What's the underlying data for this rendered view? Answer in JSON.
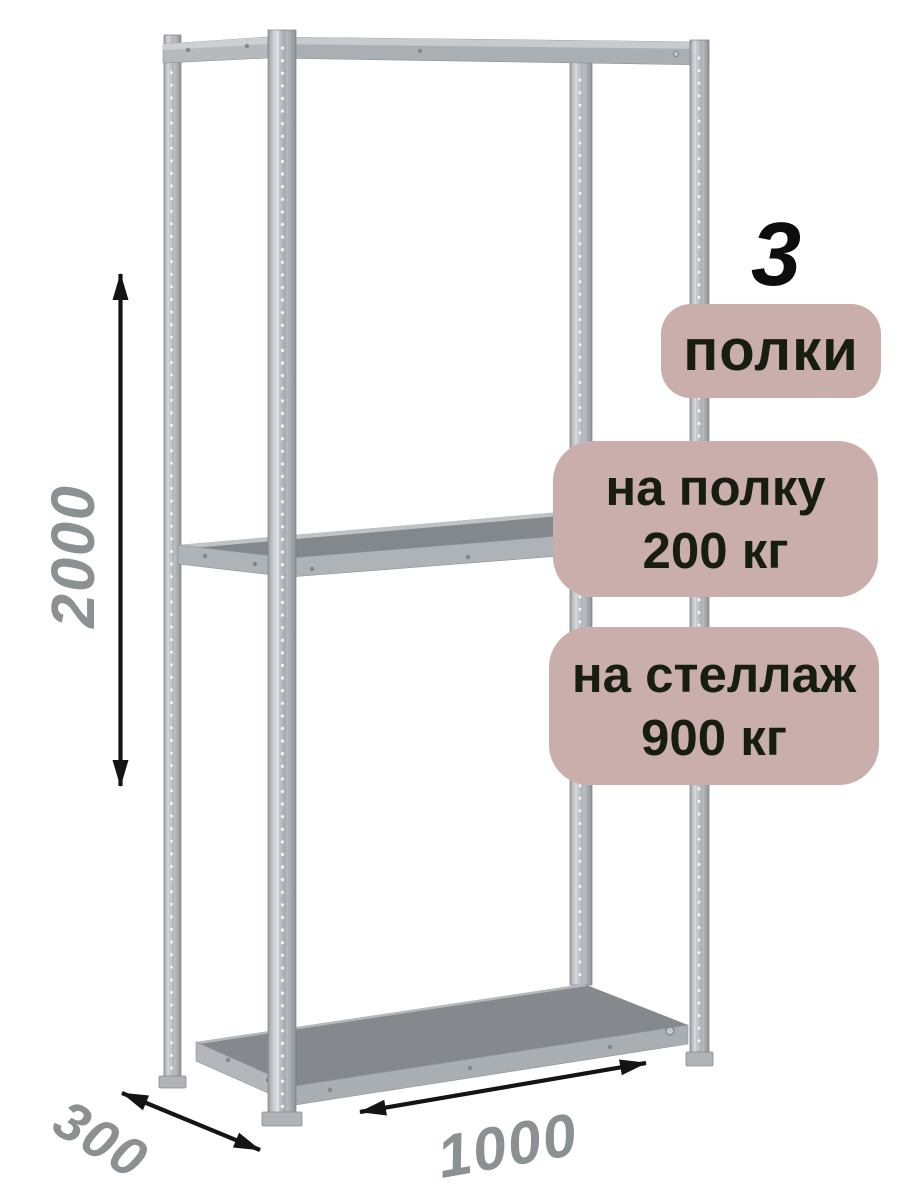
{
  "badges": {
    "count": {
      "number": "3",
      "label": "полки"
    },
    "per_shelf": {
      "line1": "на полку",
      "line2": "200 кг"
    },
    "per_rack": {
      "line1": "на стеллаж",
      "line2": "900 кг"
    }
  },
  "dimensions": {
    "height": "2000",
    "depth": "300",
    "width": "1000"
  },
  "colors": {
    "badge_bg": "#c9aeac",
    "badge_text": "#181d12",
    "dimension_text": "#8b9093",
    "arrow": "#141414",
    "count_text": "#0d0d0d",
    "metal_light": "#e2e4e6",
    "metal_mid": "#aaafb4",
    "metal_dark": "#85898e"
  }
}
